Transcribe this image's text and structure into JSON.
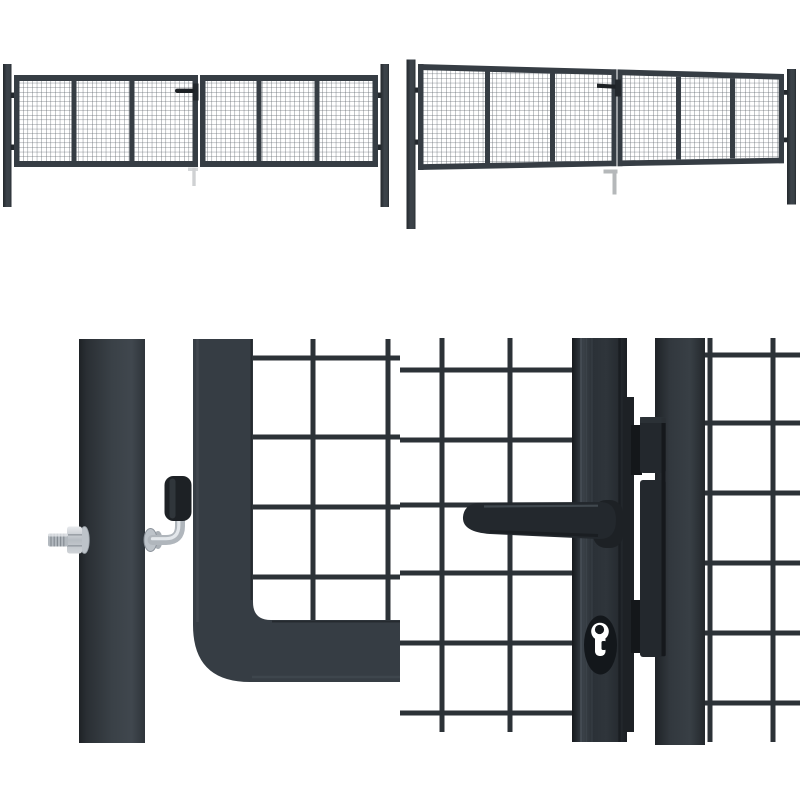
{
  "page": {
    "kind": "product-photo-collage",
    "subject": "Anthracite grey steel mesh garden gate with posts",
    "background": "#ffffff"
  },
  "colors": {
    "white": "#ffffff",
    "anthracite": "#363d44",
    "anthracite_dark": "#23282d",
    "anthracite_deep": "#1d2125",
    "mesh_fine": "#5d646b",
    "mesh_coarse": "#2c3237",
    "silver": "#bdc3c9",
    "silver_light": "#e9ecef",
    "silver_dark": "#878f96",
    "rod_light": "#cfd1d3",
    "rod_mid": "#b5b8ba",
    "lock_black": "#13171b"
  },
  "panels": [
    {
      "id": "gate-front-view",
      "label": "Double mesh garden gate, front view: two round posts, six mesh panels, centre latch handle and drop rod"
    },
    {
      "id": "gate-perspective-view",
      "label": "Double mesh garden gate, angled perspective view with posts, latch handle and drop rod"
    },
    {
      "id": "hinge-detail",
      "label": "Close-up of adjustable hinge: threaded bolt with nut and washer through round post, elbow pin into hinge sleeve on gate frame corner"
    },
    {
      "id": "handle-lock-detail",
      "label": "Close-up of lever handle, euro profile cylinder keyhole and latch keeper plate between gate stile and post"
    }
  ]
}
